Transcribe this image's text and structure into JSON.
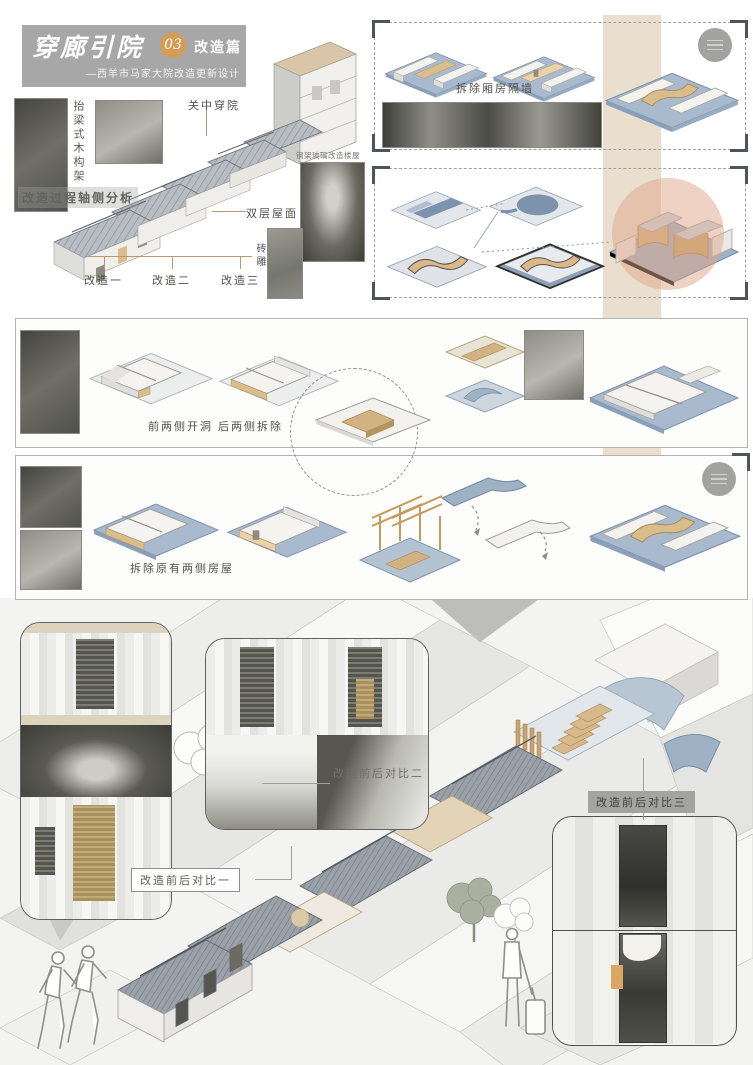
{
  "header": {
    "title": "穿廊引院",
    "badge": "03",
    "section": "改造篇",
    "subtitle": "—西羊市马家大院改造更新设计"
  },
  "axon_overview": {
    "analysis_label": "改造过程轴侧分析",
    "timber_frame": "抬梁式木构架",
    "courtyard_type": "关中穿院",
    "glass_note": "钢架玻璃改造楼屋",
    "double_roof": "双层屋面",
    "brick_carving": "砖雕",
    "step1": "改造一",
    "step2": "改造二",
    "step3": "改造三"
  },
  "steps": {
    "demolish_partitions": "拆除厢房隔墙",
    "open_front_remove_back": "前两侧开洞 后两侧拆除",
    "remove_side_rooms": "拆除原有两侧房屋"
  },
  "comparisons": {
    "c1": "改造前后对比一",
    "c2": "改造前后对比二",
    "c3": "改造前后对比三"
  },
  "colors": {
    "accent_orange": "#d49c55",
    "title_gray": "#a7a7a7",
    "tan_band": "#d8c3a5",
    "highlight_circle": "#e0b094",
    "platform_blue": "#a9bacf",
    "wood_tan": "#d9bd8d",
    "roof_gray": "#9ba1a8"
  }
}
